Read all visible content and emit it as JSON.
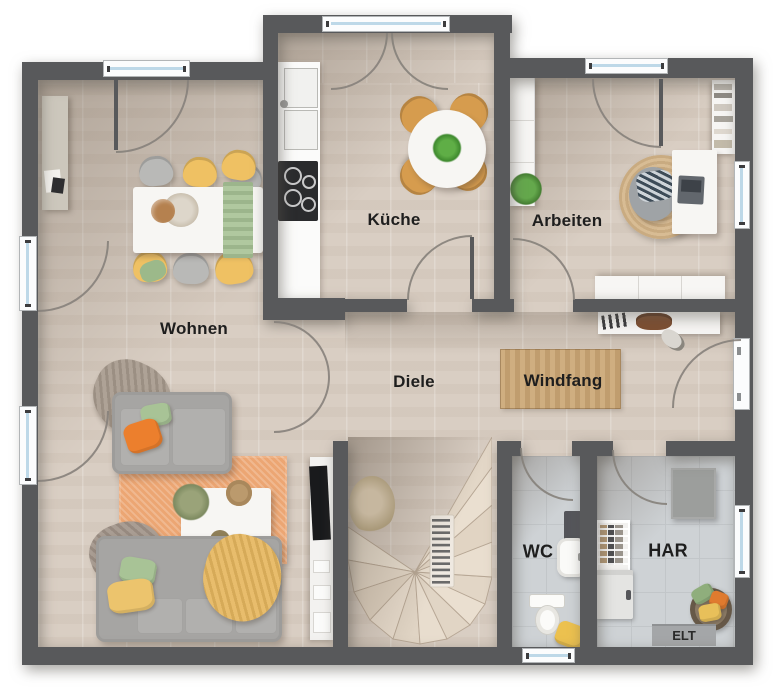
{
  "plan": {
    "rooms": [
      {
        "id": "wohnen",
        "label": "Wohnen"
      },
      {
        "id": "kueche",
        "label": "Küche"
      },
      {
        "id": "arbeiten",
        "label": "Arbeiten"
      },
      {
        "id": "diele",
        "label": "Diele"
      },
      {
        "id": "windfang",
        "label": "Windfang"
      },
      {
        "id": "wc",
        "label": "WC"
      },
      {
        "id": "har",
        "label": "HAR"
      }
    ],
    "elt_label": "ELT",
    "palette": {
      "wall": "#58595b",
      "floor_wood": "#d9cec3",
      "floor_tile": "#ced2d5",
      "rug_orange": "#eca673",
      "rug_jute": "#d0b288",
      "chair_yellow": "#efc163",
      "chair_wood": "#d69c4e",
      "sofa_grey": "#a6a5a3",
      "pillow_orange": "#ec7f2d",
      "pillow_green": "#a8c396",
      "blanket_yellow": "#e6b75f",
      "window_glass": "#bdd8e8"
    }
  }
}
